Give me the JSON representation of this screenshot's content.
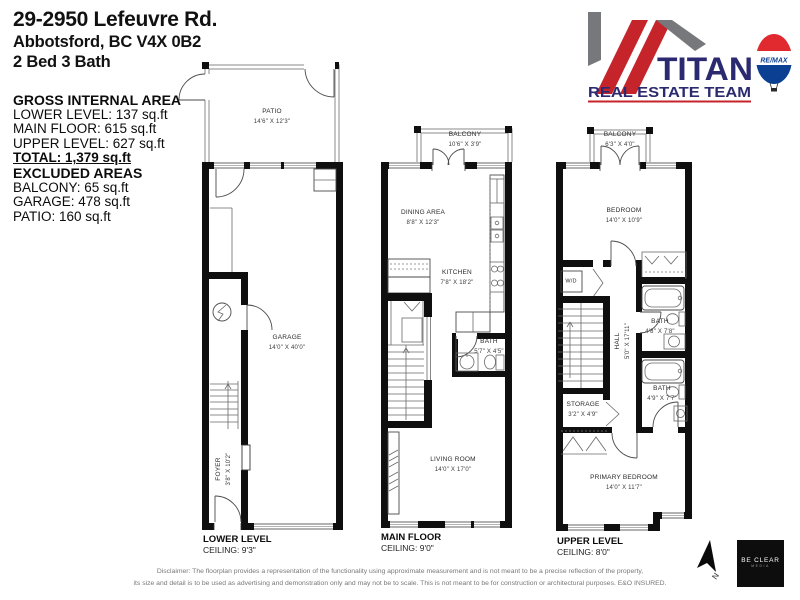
{
  "header": {
    "address_line1": "29-2950 Lefeuvre Rd.",
    "address_line2": "Abbotsford, BC V4X 0B2",
    "beds_baths": "2 Bed 3 Bath"
  },
  "area_summary": {
    "title": "GROSS INTERNAL AREA",
    "lower": "LOWER LEVEL: 137 sq.ft",
    "main": "MAIN FLOOR: 615 sq.ft",
    "upper": "UPPER LEVEL: 627 sq.ft",
    "total": "TOTAL: 1,379 sq.ft",
    "excluded_title": "EXCLUDED AREAS",
    "excluded_balcony": "BALCONY: 65 sq.ft",
    "excluded_garage": "GARAGE: 478 sq.ft",
    "excluded_patio": "PATIO: 160 sq.ft"
  },
  "logo": {
    "brand": "TITAN",
    "subtitle": "REAL ESTATE TEAM",
    "remax": "RE/MAX",
    "navy": "#2b2a70",
    "red": "#c5242b",
    "gray": "#77787b",
    "remax_red": "#e02a2f",
    "remax_blue": "#0b3f91"
  },
  "plans": {
    "lower": {
      "level_label": "LOWER LEVEL",
      "ceiling": "CEILING: 9'3\"",
      "rooms": {
        "patio": {
          "name": "PATIO",
          "dims": "14'6\" X 12'3\""
        },
        "garage": {
          "name": "GARAGE",
          "dims": "14'0\" X 40'0\""
        },
        "foyer": {
          "name": "FOYER",
          "dims": "3'8\" X 10'2\""
        }
      }
    },
    "main": {
      "level_label": "MAIN FLOOR",
      "ceiling": "CEILING: 9'0\"",
      "rooms": {
        "balcony": {
          "name": "BALCONY",
          "dims": "10'6\" X 3'9\""
        },
        "dining": {
          "name": "DINING AREA",
          "dims": "8'8\" X 12'3\""
        },
        "kitchen": {
          "name": "KITCHEN",
          "dims": "7'8\" X 18'2\""
        },
        "bath": {
          "name": "BATH",
          "dims": "5'7\" X 4'5\""
        },
        "living": {
          "name": "LIVING ROOM",
          "dims": "14'0\" X 17'0\""
        }
      }
    },
    "upper": {
      "level_label": "UPPER LEVEL",
      "ceiling": "CEILING: 8'0\"",
      "rooms": {
        "balcony": {
          "name": "BALCONY",
          "dims": "6'3\" X 4'0\""
        },
        "bedroom": {
          "name": "BEDROOM",
          "dims": "14'0\" X 10'9\""
        },
        "wd": {
          "name": "W/D"
        },
        "bath1": {
          "name": "BATH",
          "dims": "4'8\" X 7'8\""
        },
        "hall": {
          "name": "HALL",
          "dims": "5'0\" X 17'11\""
        },
        "bath2": {
          "name": "BATH",
          "dims": "4'9\" X 7'7\""
        },
        "storage": {
          "name": "STORAGE",
          "dims": "3'2\" X 4'9\""
        },
        "primary": {
          "name": "PRIMARY BEDROOM",
          "dims": "14'0\" X 11'7\""
        }
      }
    }
  },
  "footer": {
    "disclaimer_line1": "Disclaimer: The floorplan provides a representation of the functionality using approximate measurement and is not meant to be a precise reflection of the property,",
    "disclaimer_line2": "its size and detail is to be used as advertising and demonstration only and may not be to scale. This is not meant to be for construction or architectural purposes. E&O INSURED.",
    "north_label": "N",
    "beclear_line1": "BE CLEAR",
    "beclear_line2": "MEDIA"
  }
}
